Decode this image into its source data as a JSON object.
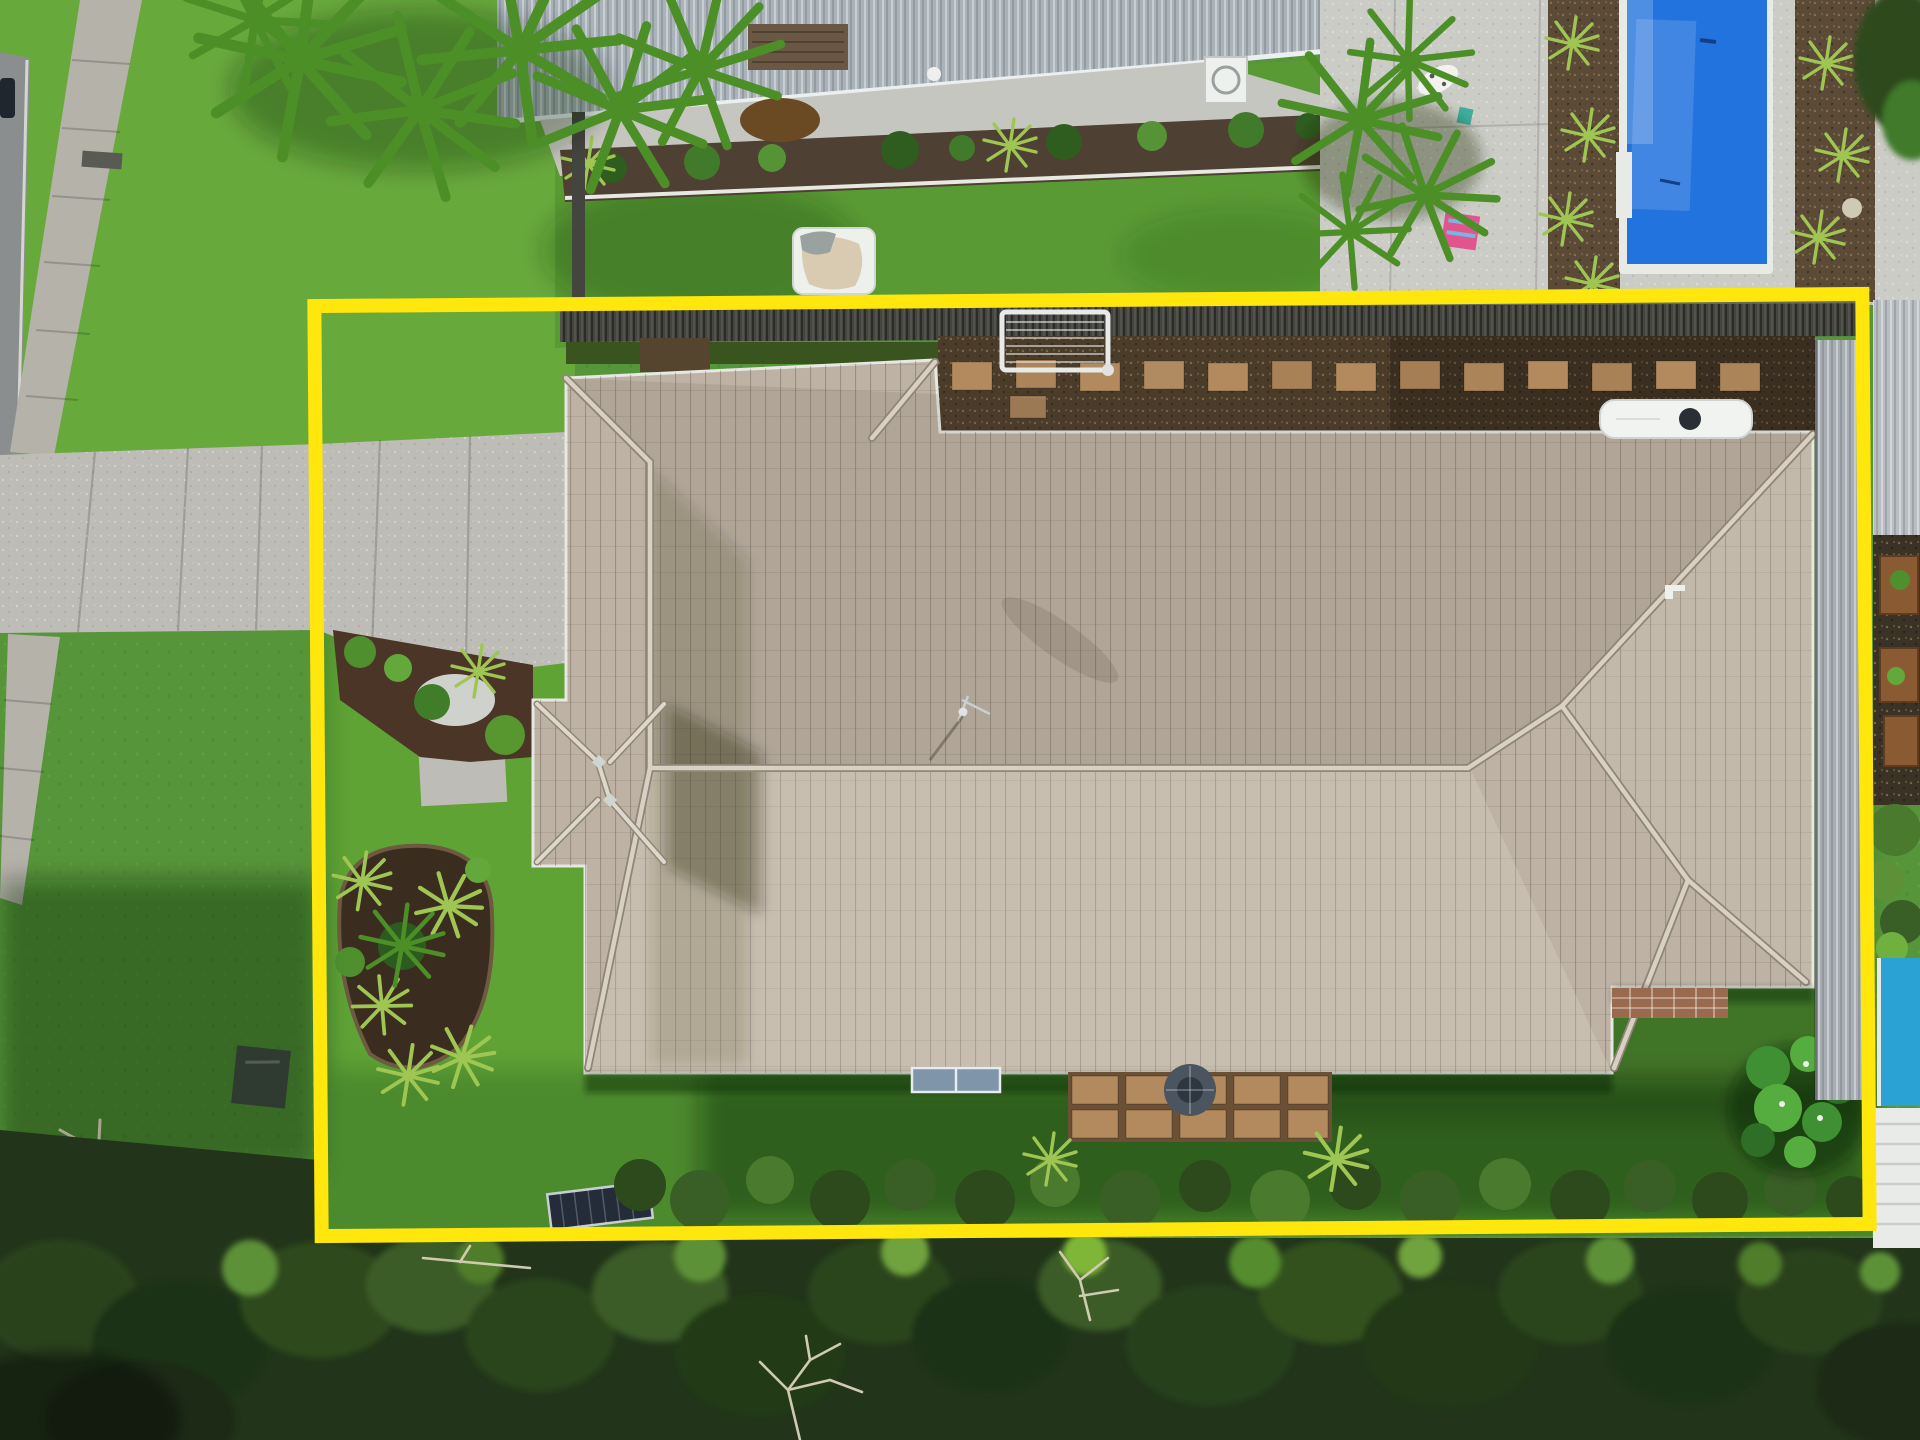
{
  "meta": {
    "title": "Aerial drone photograph of a single-storey tiled-roof home with a yellow property-boundary outline drawn over the lot",
    "image_type": "aerial-photo",
    "width_px": 1920,
    "height_px": 1440,
    "text_on_screen": "none"
  },
  "boundary": {
    "shape": "rectangle",
    "color": "#ffe70d",
    "stroke_px": 14,
    "x": 318,
    "y": 300,
    "width": 1548,
    "height": 930,
    "rotation_deg": -0.45
  },
  "scene": {
    "colors": {
      "lawn_bright": "#68a93c",
      "lawn_mid": "#57953a",
      "lawn_rear": "#4c8a2e",
      "lawn_shadow": "#2d4f1e",
      "concrete_driveway": "#bdbcb6",
      "footpath": "#b5b2aa",
      "pool_deck": "#cbccc6",
      "road": "#8b8e8e",
      "roof_tile": "#bdb2a3",
      "roof_ridge": "#d8d0c3",
      "metal_roof": "#a9b3b9",
      "fence_dark": "#454540",
      "boundary_fence_gray": "#a7adb2",
      "gravel_bed": "#4b3c2a",
      "mulch": "#4a3526",
      "paver_tan": "#b28a5e",
      "brick_patio": "#9a6a4e",
      "pool_blue": "#2273de",
      "pool_cyan": "#2aa3d4",
      "kiddie_pool_blue": "#2e9fe2",
      "towel_pink": "#e0558e",
      "tree_dark": "#22351a",
      "tree_mid": "#3a5c26",
      "tree_light": "#5d9138",
      "caravan_white": "#f1f3f1",
      "sandpit_white": "#eef0ec",
      "sand": "#d9cbb2",
      "solar_panel_dark": "#232c38",
      "wall_panel_blue": "#7e95aa",
      "boundary_yellow": "#ffe70d"
    },
    "regions": [
      {
        "name": "street-verge",
        "desc": "road edge, concrete footpath and bright lawn",
        "where": "top-left"
      },
      {
        "name": "neighbor-house-metal-roof",
        "desc": "corrugated metal roof with white fascia, garden bed and rear lawn",
        "where": "top-middle"
      },
      {
        "name": "neighbor-pool-area",
        "desc": "royal-blue in-ground pool with concrete deck, gravel beds and palms",
        "where": "top-right"
      },
      {
        "name": "subject-house",
        "desc": "large hipped tiled roof with small pyramid porch roof, driveway on west side",
        "where": "center"
      },
      {
        "name": "rear-yard",
        "desc": "lawn, paver patio, fire pit, garden island, solar panel, hedge row",
        "where": "lower-center"
      },
      {
        "name": "bush-reserve",
        "desc": "dense tree canopy band with dead white branches",
        "where": "bottom"
      },
      {
        "name": "right-neighbor",
        "desc": "gray boundary fence, planter boxes, cyan pool corner and white pergola",
        "where": "right edge"
      }
    ],
    "objects": [
      {
        "name": "main-roof",
        "approx": [
          566,
          360,
          1813,
          1073
        ]
      },
      {
        "name": "porch-pavilion-roof",
        "approx": [
          533,
          700,
          668,
          866
        ]
      },
      {
        "name": "driveway",
        "approx": [
          0,
          442,
          566,
          663
        ]
      },
      {
        "name": "footpath",
        "approx": [
          8,
          0,
          140,
          905
        ]
      },
      {
        "name": "sandpit",
        "approx": [
          793,
          228,
          875,
          294
        ]
      },
      {
        "name": "clothesline",
        "approx": [
          1002,
          312,
          1108,
          370
        ]
      },
      {
        "name": "stepping-stones",
        "approx": [
          952,
          360,
          1760,
          392
        ]
      },
      {
        "name": "caravan-roof",
        "approx": [
          1600,
          400,
          1752,
          438
        ]
      },
      {
        "name": "neighbor-pool",
        "approx": [
          1623,
          0,
          1769,
          270
        ]
      },
      {
        "name": "kiddie-pool",
        "approx": [
          1432,
          348,
          1480,
          396
        ]
      },
      {
        "name": "ac-unit",
        "approx": [
          1205,
          57,
          1247,
          103
        ]
      },
      {
        "name": "ground-solar-panel",
        "approx": [
          549,
          1188,
          650,
          1224
        ]
      },
      {
        "name": "wall-solar-panels",
        "approx": [
          912,
          1068,
          1000,
          1092
        ]
      },
      {
        "name": "paver-patio-and-firepit",
        "approx": [
          1068,
          1072,
          1332,
          1142
        ]
      },
      {
        "name": "brick-strip",
        "approx": [
          1612,
          988,
          1728,
          1018
        ]
      },
      {
        "name": "garden-island",
        "approx": [
          328,
          845,
          492,
          1090
        ]
      },
      {
        "name": "frangipani-tree",
        "approx": [
          1738,
          1040,
          1860,
          1180
        ]
      },
      {
        "name": "utility-box",
        "approx": [
          234,
          1048,
          288,
          1106
        ]
      },
      {
        "name": "pergola-white",
        "approx": [
          1873,
          1108,
          1920,
          1248
        ]
      }
    ]
  }
}
